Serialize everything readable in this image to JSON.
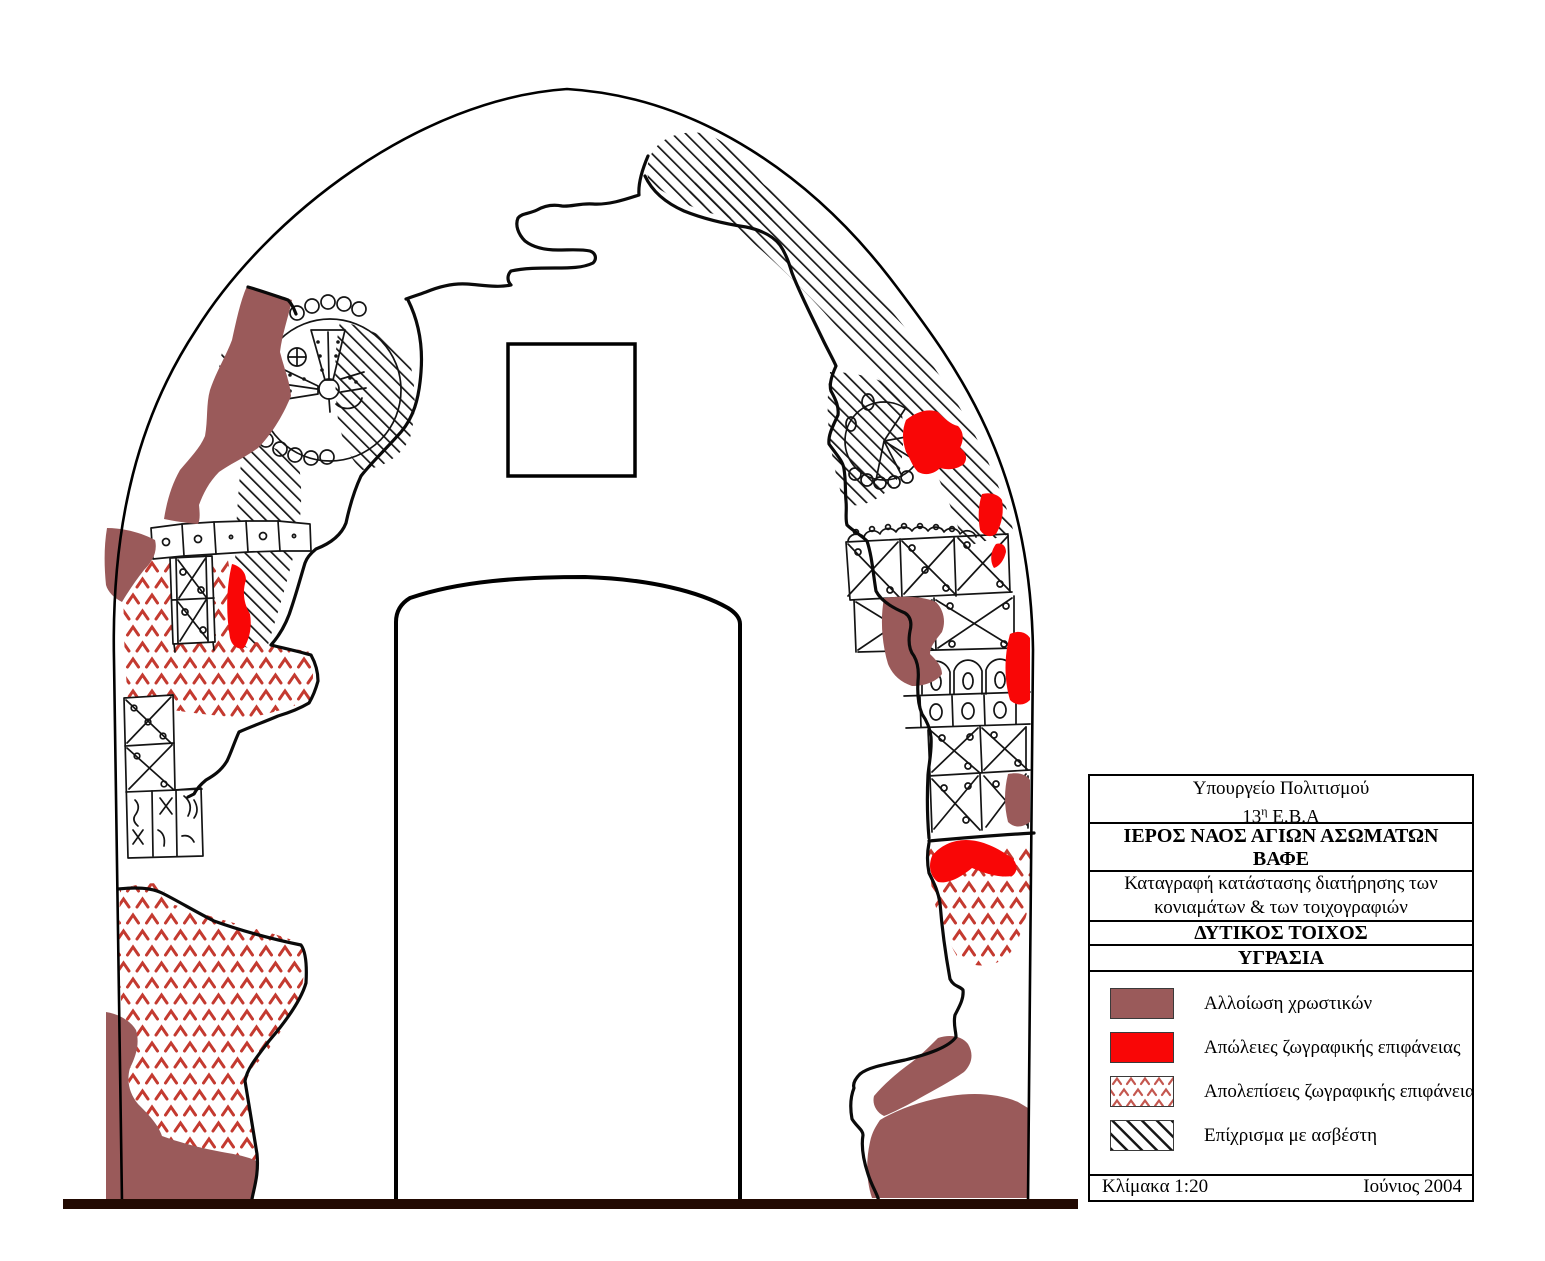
{
  "title_block": {
    "ministry": "Υπουργείο Πολιτισμού",
    "ephorate_number": "13",
    "ephorate_superscript": "η",
    "ephorate_rest": " Ε.Β.Α",
    "church_name": "ΙΕΡΟΣ ΝΑΟΣ ΑΓΙΩΝ ΑΣΩΜΑΤΩΝ",
    "village": "ΒΑΦΕ",
    "subject_line1": "Καταγραφή κατάστασης διατήρησης των",
    "subject_line2": "κονιαμάτων & των τοιχογραφιών",
    "wall_title": "ΔΥΤΙΚΟΣ ΤΟΙΧΟΣ",
    "condition_title": "ΥΓΡΑΣΙΑ",
    "scale_label": "Κλίμακα 1:20",
    "date_label": "Ιούνιος 2004"
  },
  "legend": {
    "items": [
      {
        "label": "Αλλοίωση χρωστικών",
        "swatch": "pigment-alteration-brown"
      },
      {
        "label": "Απώλειες ζωγραφικής επιφάνειας",
        "swatch": "paint-loss-red"
      },
      {
        "label": "Απολεπίσεις ζωγραφικής επιφάνειας",
        "swatch": "flaking-chevron-pattern"
      },
      {
        "label": "Επίχρισμα με ασβέστη",
        "swatch": "lime-plaster-hatch-pattern"
      }
    ]
  },
  "colors": {
    "pigment_alteration": "#9a5a5a",
    "paint_loss": "#f90606",
    "flaking_chevron": "#c43a30",
    "lime_hatch_line": "#161616",
    "ground_line": "#220a02",
    "drawing_outline": "#000000"
  }
}
